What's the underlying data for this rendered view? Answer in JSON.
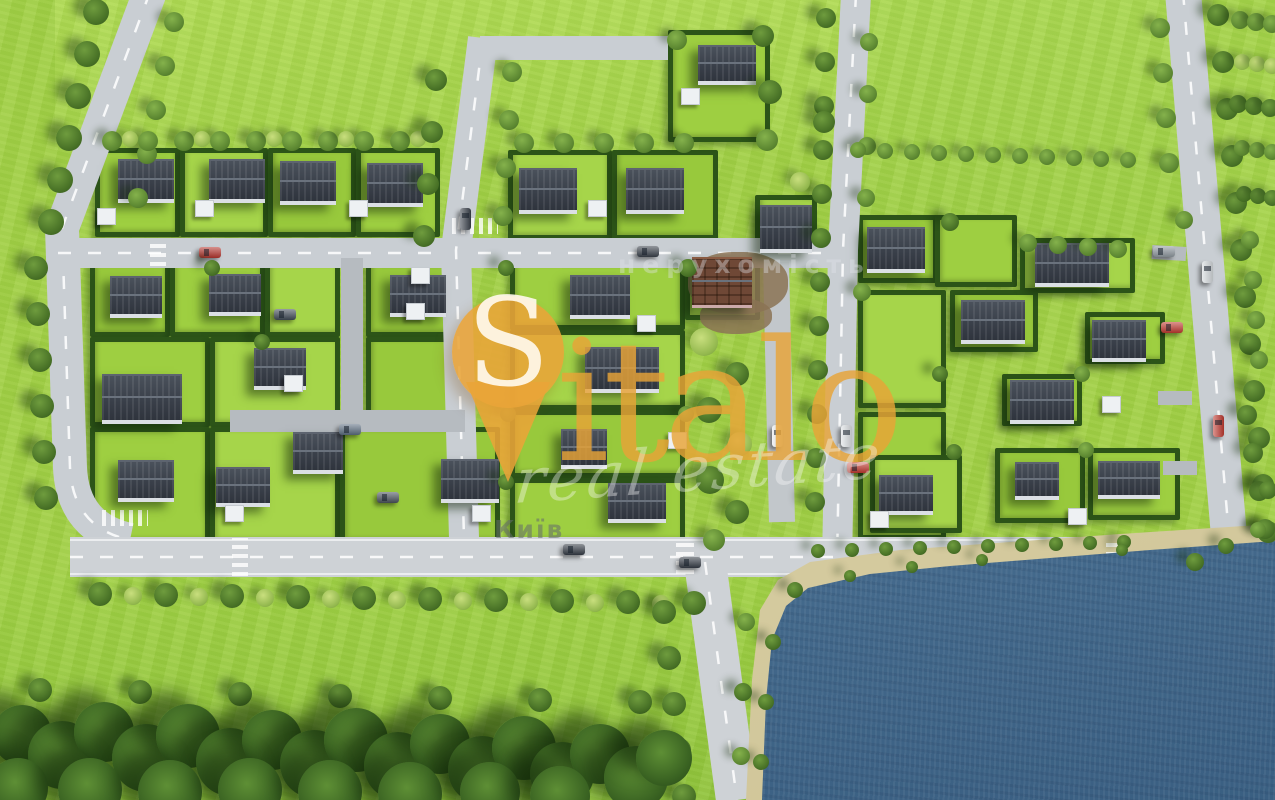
{
  "watermark": {
    "brand_s": "S",
    "brand_rest": "italo",
    "script": "real estate",
    "overlay_label": "нерухомість",
    "city_label": "Київ",
    "pin_color": "#E9A438",
    "brand_color": "rgba(232,163,55,0.82)",
    "script_color": "rgba(250,250,250,0.38)"
  },
  "palette": {
    "grass": "#a3d146",
    "grass_light": "#aed952",
    "grass_dark": "#92c43c",
    "road": "#c9ced3",
    "road_main": "#ced2d6",
    "driveway": "#b6bbc0",
    "hedge": "#2c5418",
    "roof": "#3a404a",
    "roof_construction": "#6f4836",
    "water": "#476d8f",
    "sand": "#d8cfa4",
    "tree_dark": "#466f25",
    "tree_light": "#93b84e",
    "car_red": "#c03a31",
    "car_white": "#e9ecee"
  },
  "scene": {
    "fields": [
      {
        "x": 55,
        "y": 0,
        "w": 790,
        "h": 150,
        "bg": "linear-gradient(180deg,#b1db54,#a6d44a)"
      },
      {
        "x": 858,
        "y": 0,
        "w": 330,
        "h": 235,
        "bg": "linear-gradient(180deg,#abd851,#a0d046)"
      },
      {
        "x": 0,
        "y": 575,
        "w": 760,
        "h": 225,
        "bg": "linear-gradient(180deg,#a2d246,#92c43c)"
      },
      {
        "x": 1188,
        "y": 0,
        "w": 87,
        "h": 230,
        "bg": "#a6d44a"
      }
    ],
    "beach_poly": "polygon(746px 800px,752px 680px,760px 610px,778px 580px,810px 562px,900px 550px,1010px 542px,1120px 534px,1275px 524px,1275px 800px)",
    "water_poly": "polygon(762px 800px,766px 700px,772px 640px,786px 606px,808px 588px,870px 574px,950px 566px,1050px 558px,1150px 550px,1275px 541px,1275px 800px)",
    "plots": [
      [
        95,
        148,
        85,
        89
      ],
      [
        180,
        148,
        88,
        89
      ],
      [
        268,
        148,
        88,
        89
      ],
      [
        356,
        148,
        84,
        89
      ],
      [
        508,
        150,
        104,
        90
      ],
      [
        612,
        150,
        106,
        90
      ],
      [
        668,
        30,
        102,
        112
      ],
      [
        755,
        195,
        62,
        62
      ],
      [
        90,
        262,
        80,
        75
      ],
      [
        170,
        262,
        95,
        75
      ],
      [
        265,
        262,
        75,
        75
      ],
      [
        366,
        262,
        94,
        75
      ],
      [
        90,
        337,
        120,
        90
      ],
      [
        210,
        337,
        130,
        90
      ],
      [
        366,
        337,
        94,
        90
      ],
      [
        90,
        427,
        120,
        118
      ],
      [
        210,
        427,
        130,
        118
      ],
      [
        340,
        427,
        160,
        118
      ],
      [
        510,
        262,
        175,
        68
      ],
      [
        510,
        330,
        175,
        80
      ],
      [
        510,
        410,
        175,
        68
      ],
      [
        510,
        478,
        175,
        67
      ],
      [
        685,
        250,
        75,
        70
      ],
      [
        858,
        215,
        80,
        68
      ],
      [
        935,
        215,
        82,
        72
      ],
      [
        1020,
        238,
        115,
        55
      ],
      [
        950,
        290,
        88,
        62
      ],
      [
        1085,
        312,
        80,
        52
      ],
      [
        858,
        290,
        88,
        118
      ],
      [
        1002,
        374,
        80,
        52
      ],
      [
        858,
        412,
        88,
        128
      ],
      [
        870,
        455,
        92,
        78
      ],
      [
        995,
        448,
        90,
        75
      ],
      [
        1088,
        448,
        92,
        72
      ]
    ],
    "roads": [
      {
        "d": "M150,-8 L62,228 L70,468 Q73,528 130,540",
        "w": 34,
        "c": "#c9ced3",
        "dash": true
      },
      {
        "d": "M58,253 L845,253",
        "w": 30,
        "c": "#c9ced3",
        "dash": true
      },
      {
        "d": "M483,38 L456,250 L464,538",
        "w": 30,
        "c": "#c9ced3",
        "dash": true
      },
      {
        "d": "M480,48 L668,48",
        "w": 24,
        "c": "#c9ced3",
        "dash": false
      },
      {
        "d": "M856,-6 L843,250 L837,562",
        "w": 30,
        "c": "#c9ced3",
        "dash": true
      },
      {
        "d": "M1183,-8 L1230,548",
        "w": 36,
        "c": "#c9ced3",
        "dash": true
      },
      {
        "d": "M352,258 L352,422",
        "w": 22,
        "c": "#b6bbc0",
        "dash": false
      },
      {
        "d": "M230,421 L465,421",
        "w": 22,
        "c": "#b6bbc0",
        "dash": false
      },
      {
        "d": "M776,262 L782,522",
        "w": 26,
        "c": "#c2c7cb",
        "dash": false
      },
      {
        "d": "M1152,252 L1186,254",
        "w": 14,
        "c": "#b6bbc0",
        "dash": false
      },
      {
        "d": "M1158,398 L1192,398",
        "w": 14,
        "c": "#b6bbc0",
        "dash": false
      },
      {
        "d": "M1163,468 L1197,468",
        "w": 14,
        "c": "#b6bbc0",
        "dash": false
      },
      {
        "d": "M70,557 L1275,557",
        "w": 40,
        "c": "#ced2d6",
        "dash": true
      },
      {
        "d": "M70,540 L1275,540",
        "w": 2,
        "c": "rgba(255,255,255,0.6)",
        "dash": false
      },
      {
        "d": "M70,574 L1275,574",
        "w": 2,
        "c": "rgba(255,255,255,0.6)",
        "dash": false
      },
      {
        "d": "M705,562 L737,800",
        "w": 42,
        "c": "#ced2d6",
        "dash": true
      }
    ],
    "crosswalks": [
      {
        "x": 452,
        "y": 218,
        "w": 46,
        "h": 16,
        "dir": 90
      },
      {
        "x": 102,
        "y": 510,
        "w": 46,
        "h": 16,
        "dir": 90
      },
      {
        "x": 150,
        "y": 240,
        "w": 16,
        "h": 26,
        "dir": 0
      },
      {
        "x": 232,
        "y": 538,
        "w": 16,
        "h": 38,
        "dir": 0
      },
      {
        "x": 676,
        "y": 540,
        "w": 18,
        "h": 34,
        "dir": 0
      },
      {
        "x": 1106,
        "y": 540,
        "w": 18,
        "h": 34,
        "dir": 0
      }
    ],
    "dirt_patches": [
      [
        688,
        252,
        100,
        62
      ],
      [
        700,
        298,
        72,
        36
      ]
    ],
    "houses": [
      [
        146,
        178,
        56,
        38
      ],
      [
        237,
        178,
        56,
        38
      ],
      [
        308,
        180,
        56,
        38
      ],
      [
        395,
        182,
        56,
        38
      ],
      [
        548,
        188,
        58,
        40
      ],
      [
        655,
        188,
        58,
        40
      ],
      [
        727,
        62,
        58,
        34
      ],
      [
        786,
        226,
        52,
        42
      ],
      [
        896,
        247,
        58,
        40
      ],
      [
        1072,
        262,
        74,
        38
      ],
      [
        136,
        294,
        52,
        36
      ],
      [
        235,
        292,
        52,
        36
      ],
      [
        418,
        293,
        56,
        36
      ],
      [
        142,
        396,
        80,
        44
      ],
      [
        280,
        366,
        52,
        36
      ],
      [
        318,
        450,
        50,
        36
      ],
      [
        146,
        478,
        56,
        36
      ],
      [
        243,
        484,
        54,
        34
      ],
      [
        470,
        478,
        58,
        38
      ],
      [
        600,
        294,
        60,
        38
      ],
      [
        622,
        367,
        74,
        40
      ],
      [
        584,
        446,
        46,
        34
      ],
      [
        637,
        500,
        58,
        34
      ],
      [
        993,
        319,
        64,
        38
      ],
      [
        1119,
        338,
        54,
        36
      ],
      [
        1042,
        399,
        64,
        38
      ],
      [
        906,
        492,
        54,
        34
      ],
      [
        1037,
        478,
        44,
        32
      ],
      [
        1129,
        477,
        62,
        32
      ]
    ],
    "construction_house": [
      722,
      280,
      60,
      46
    ],
    "sheds": [
      [
        105,
        215
      ],
      [
        203,
        207
      ],
      [
        357,
        207
      ],
      [
        596,
        207
      ],
      [
        689,
        95
      ],
      [
        419,
        274
      ],
      [
        292,
        382
      ],
      [
        414,
        310
      ],
      [
        233,
        512
      ],
      [
        480,
        512
      ],
      [
        645,
        322
      ],
      [
        676,
        439
      ],
      [
        1110,
        403
      ],
      [
        1076,
        515
      ],
      [
        878,
        518
      ]
    ],
    "cars": [
      [
        210,
        252,
        "h",
        "#b5352e"
      ],
      [
        648,
        251,
        "h",
        "#3a414b"
      ],
      [
        465,
        219,
        "v",
        "#3a414b"
      ],
      [
        350,
        429,
        "h",
        "#5c6d80"
      ],
      [
        574,
        549,
        "h",
        "#353c46"
      ],
      [
        690,
        562,
        "h",
        "#353c46"
      ],
      [
        777,
        436,
        "v",
        "#e9ecee"
      ],
      [
        846,
        436,
        "v",
        "#dde1e4"
      ],
      [
        858,
        467,
        "h",
        "#c03a31"
      ],
      [
        1172,
        327,
        "h",
        "#c03a31"
      ],
      [
        1164,
        251,
        "h",
        "#9099a0"
      ],
      [
        1207,
        272,
        "v",
        "#d5dadd"
      ],
      [
        1218,
        426,
        "v",
        "#c03a31"
      ],
      [
        285,
        314,
        "h",
        "#404a56"
      ],
      [
        388,
        497,
        "h",
        "#4a525c"
      ]
    ],
    "tree_rows": [
      {
        "x": 96,
        "y": 12,
        "dx": -9,
        "dy": 42,
        "n": 6,
        "r": 13,
        "tone": "dark"
      },
      {
        "x": 174,
        "y": 22,
        "dx": -9,
        "dy": 44,
        "n": 5,
        "r": 10,
        "tone": "mid"
      },
      {
        "x": 36,
        "y": 268,
        "dx": 2,
        "dy": 46,
        "n": 6,
        "r": 12,
        "tone": "dark"
      },
      {
        "x": 112,
        "y": 141,
        "dx": 36,
        "dy": 0,
        "n": 9,
        "r": 10,
        "tone": "mid"
      },
      {
        "x": 130,
        "y": 139,
        "dx": 72,
        "dy": 0,
        "n": 5,
        "r": 8,
        "tone": "light"
      },
      {
        "x": 524,
        "y": 143,
        "dx": 40,
        "dy": 0,
        "n": 5,
        "r": 10,
        "tone": "mid"
      },
      {
        "x": 436,
        "y": 80,
        "dx": -4,
        "dy": 52,
        "n": 4,
        "r": 11,
        "tone": "dark"
      },
      {
        "x": 512,
        "y": 72,
        "dx": -3,
        "dy": 48,
        "n": 4,
        "r": 10,
        "tone": "mid"
      },
      {
        "x": 826,
        "y": 18,
        "dx": -1,
        "dy": 44,
        "n": 12,
        "r": 10,
        "tone": "dark"
      },
      {
        "x": 869,
        "y": 42,
        "dx": -1,
        "dy": 52,
        "n": 4,
        "r": 9,
        "tone": "mid"
      },
      {
        "x": 1218,
        "y": 15,
        "dx": 4.5,
        "dy": 47,
        "n": 12,
        "r": 11,
        "tone": "dark"
      },
      {
        "x": 1160,
        "y": 28,
        "dx": 3,
        "dy": 45,
        "n": 4,
        "r": 10,
        "tone": "mid"
      },
      {
        "x": 858,
        "y": 150,
        "dx": 27,
        "dy": 1,
        "n": 11,
        "r": 8,
        "tone": "mid"
      },
      {
        "x": 100,
        "y": 594,
        "dx": 66,
        "dy": 1,
        "n": 10,
        "r": 12,
        "tone": "dark"
      },
      {
        "x": 133,
        "y": 596,
        "dx": 66,
        "dy": 1,
        "n": 9,
        "r": 9,
        "tone": "light"
      },
      {
        "x": 818,
        "y": 551,
        "dx": 34,
        "dy": -1,
        "n": 10,
        "r": 7,
        "tone": "dark"
      },
      {
        "x": 664,
        "y": 612,
        "dx": 5,
        "dy": 46,
        "n": 5,
        "r": 12,
        "tone": "dark"
      },
      {
        "x": 1028,
        "y": 243,
        "dx": 30,
        "dy": 2,
        "n": 4,
        "r": 9,
        "tone": "mid"
      },
      {
        "x": 1247,
        "y": 415,
        "dx": 6,
        "dy": 38,
        "n": 4,
        "r": 10,
        "tone": "dark"
      },
      {
        "x": 40,
        "y": 690,
        "dx": 100,
        "dy": 2,
        "n": 7,
        "r": 12,
        "tone": "dark"
      },
      {
        "x": 1240,
        "y": 20,
        "dx": 16,
        "dy": 2,
        "n": 3,
        "r": 9,
        "tone": "mid"
      },
      {
        "x": 1242,
        "y": 62,
        "dx": 15,
        "dy": 2,
        "n": 3,
        "r": 8,
        "tone": "light"
      },
      {
        "x": 1238,
        "y": 104,
        "dx": 16,
        "dy": 2,
        "n": 3,
        "r": 9,
        "tone": "dark"
      },
      {
        "x": 1242,
        "y": 148,
        "dx": 15,
        "dy": 2,
        "n": 3,
        "r": 8,
        "tone": "mid"
      },
      {
        "x": 1244,
        "y": 194,
        "dx": 14,
        "dy": 2,
        "n": 3,
        "r": 8,
        "tone": "dark"
      },
      {
        "x": 1250,
        "y": 240,
        "dx": 3,
        "dy": 40,
        "n": 4,
        "r": 9,
        "tone": "mid"
      }
    ],
    "trees": [
      [
        704,
        342,
        14,
        "light"
      ],
      [
        737,
        374,
        12,
        "dark"
      ],
      [
        709,
        410,
        13,
        "dark"
      ],
      [
        740,
        444,
        12,
        "light"
      ],
      [
        710,
        480,
        14,
        "dark"
      ],
      [
        737,
        512,
        12,
        "dark"
      ],
      [
        714,
        540,
        11,
        "mid"
      ],
      [
        677,
        40,
        10,
        "mid"
      ],
      [
        763,
        36,
        11,
        "dark"
      ],
      [
        770,
        92,
        12,
        "dark"
      ],
      [
        767,
        140,
        11,
        "mid"
      ],
      [
        800,
        182,
        10,
        "light"
      ],
      [
        824,
        122,
        11,
        "dark"
      ],
      [
        212,
        268,
        8,
        "dark"
      ],
      [
        262,
        342,
        8,
        "dark"
      ],
      [
        506,
        268,
        8,
        "dark"
      ],
      [
        688,
        268,
        9,
        "dark"
      ],
      [
        508,
        414,
        8,
        "mid"
      ],
      [
        686,
        414,
        8,
        "mid"
      ],
      [
        506,
        482,
        8,
        "dark"
      ],
      [
        950,
        222,
        9,
        "dark"
      ],
      [
        1184,
        220,
        9,
        "mid"
      ],
      [
        862,
        292,
        9,
        "mid"
      ],
      [
        940,
        374,
        8,
        "dark"
      ],
      [
        1082,
        374,
        8,
        "mid"
      ],
      [
        954,
        452,
        8,
        "dark"
      ],
      [
        1086,
        450,
        8,
        "mid"
      ],
      [
        1195,
        562,
        9,
        "dark"
      ],
      [
        1226,
        546,
        8,
        "dark"
      ],
      [
        795,
        590,
        8,
        "dark"
      ],
      [
        773,
        642,
        8,
        "dark"
      ],
      [
        766,
        702,
        8,
        "dark"
      ],
      [
        761,
        762,
        8,
        "dark"
      ],
      [
        746,
        622,
        9,
        "mid"
      ],
      [
        743,
        692,
        9,
        "dark"
      ],
      [
        741,
        756,
        9,
        "mid"
      ],
      [
        850,
        576,
        6,
        "dark"
      ],
      [
        912,
        567,
        6,
        "dark"
      ],
      [
        982,
        560,
        6,
        "dark"
      ],
      [
        1122,
        550,
        6,
        "dark"
      ],
      [
        1268,
        490,
        9,
        "dark"
      ],
      [
        1258,
        530,
        8,
        "mid"
      ]
    ],
    "forest": [
      [
        22,
        735,
        30
      ],
      [
        62,
        755,
        34
      ],
      [
        104,
        732,
        30
      ],
      [
        146,
        758,
        34
      ],
      [
        188,
        736,
        32
      ],
      [
        230,
        762,
        34
      ],
      [
        272,
        740,
        30
      ],
      [
        314,
        764,
        34
      ],
      [
        356,
        740,
        32
      ],
      [
        398,
        766,
        34
      ],
      [
        440,
        744,
        30
      ],
      [
        482,
        770,
        34
      ],
      [
        524,
        748,
        32
      ],
      [
        562,
        774,
        32
      ],
      [
        600,
        754,
        30
      ],
      [
        636,
        778,
        32
      ],
      [
        664,
        758,
        28
      ],
      [
        18,
        788,
        30
      ],
      [
        90,
        790,
        32
      ],
      [
        170,
        792,
        32
      ],
      [
        250,
        790,
        32
      ],
      [
        330,
        792,
        32
      ],
      [
        410,
        794,
        32
      ],
      [
        490,
        792,
        30
      ],
      [
        560,
        796,
        30
      ]
    ]
  }
}
